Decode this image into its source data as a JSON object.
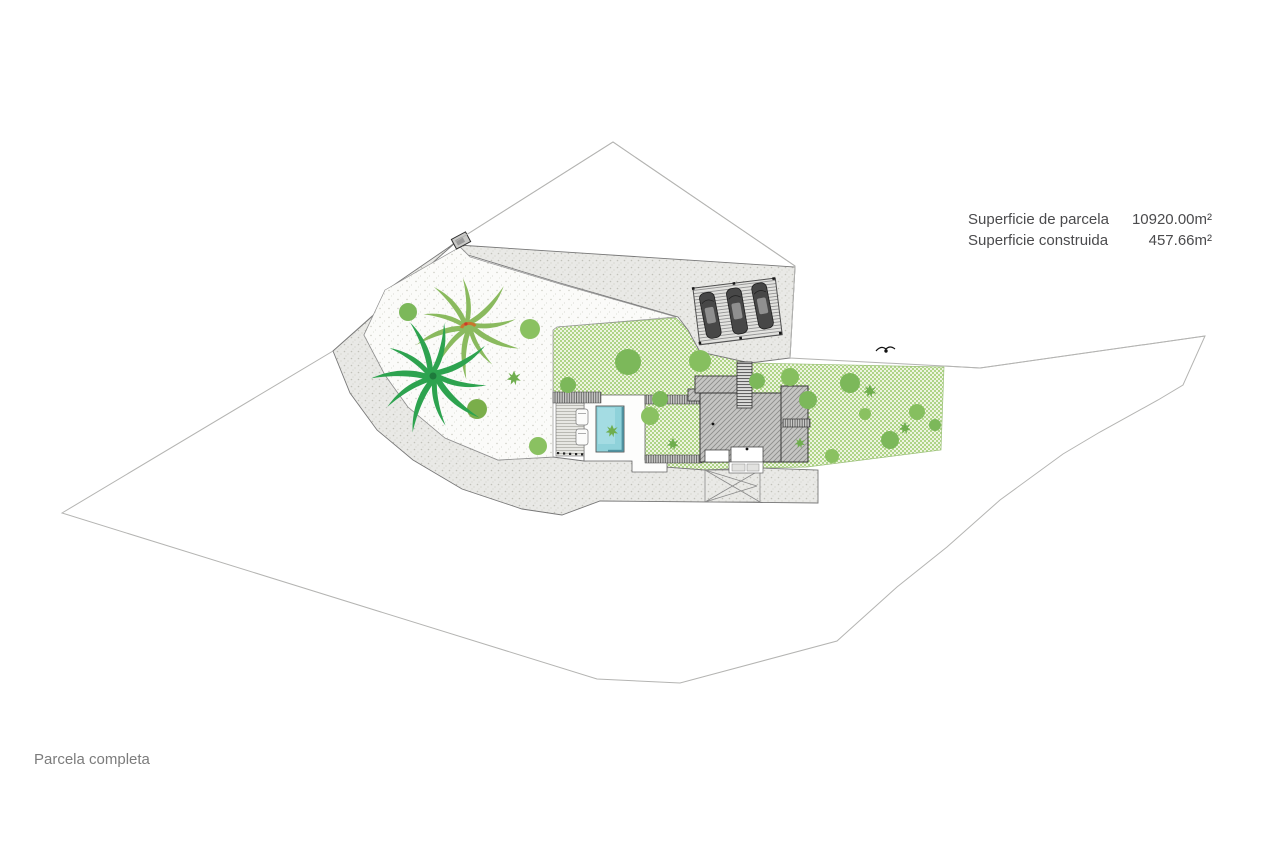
{
  "info_panel": {
    "rows": [
      {
        "label": "Superficie de parcela",
        "value": "10920.00m²"
      },
      {
        "label": "Superficie construida",
        "value": "457.66m²"
      }
    ]
  },
  "caption": "Parcela completa",
  "colors": {
    "garden_green": "#aed487",
    "gravel_gray": "#e9e9e6",
    "courtyard_white": "#fbfbf9",
    "pool_blue": "#8fd2da",
    "roof_gray": "#c5c5c3",
    "tree_green": "#7cb85a",
    "palm_dark": "#2da34f",
    "palm_light": "#8aba5e",
    "boundary_gray": "#b4b4b2"
  }
}
